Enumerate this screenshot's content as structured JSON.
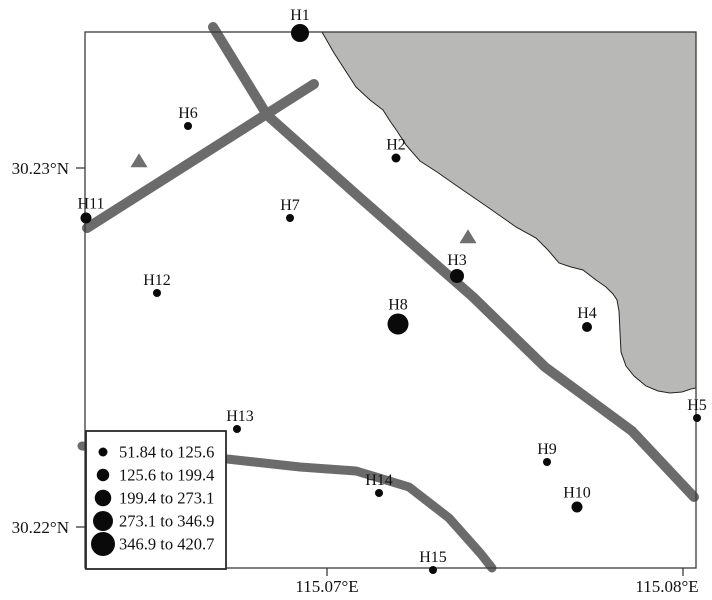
{
  "figure": {
    "kind": "station-map",
    "width": 712,
    "height": 600,
    "background": "#ffffff"
  },
  "colors": {
    "station": "#0a0a0a",
    "road": "#6b6b6b",
    "water_fill": "#b8b8b6",
    "water_outline": "#222222",
    "frame": "#3a3a3a",
    "triangle": "#6f6f6f",
    "legend_fill": "#ffffff",
    "legend_border": "#2a2a2a",
    "text": "#111111"
  },
  "map": {
    "frame": {
      "x": 85,
      "y": 32,
      "width": 611,
      "height": 536
    },
    "axes": {
      "tick_len": 9,
      "y_ticks": [
        {
          "label": "30.23°N",
          "y": 168
        },
        {
          "label": "30.22°N",
          "y": 527
        }
      ],
      "x_ticks": [
        {
          "label": "115.07°E",
          "x": 327,
          "label_x": 327
        },
        {
          "label": "115.08°E",
          "x": 683,
          "label_x": 667
        }
      ]
    },
    "water_area": {
      "name": "water-body",
      "points": [
        [
          322,
          32
        ],
        [
          334,
          53
        ],
        [
          345,
          70
        ],
        [
          356,
          87
        ],
        [
          370,
          100
        ],
        [
          383,
          110
        ],
        [
          390,
          121
        ],
        [
          397,
          131
        ],
        [
          406,
          145
        ],
        [
          420,
          161
        ],
        [
          437,
          172
        ],
        [
          457,
          186
        ],
        [
          489,
          208
        ],
        [
          516,
          227
        ],
        [
          536,
          238
        ],
        [
          548,
          250
        ],
        [
          559,
          263
        ],
        [
          571,
          267
        ],
        [
          583,
          270
        ],
        [
          596,
          280
        ],
        [
          606,
          287
        ],
        [
          613,
          294
        ],
        [
          617,
          300
        ],
        [
          619,
          311
        ],
        [
          620,
          332
        ],
        [
          621,
          352
        ],
        [
          626,
          366
        ],
        [
          634,
          376
        ],
        [
          646,
          386
        ],
        [
          658,
          391
        ],
        [
          670,
          393
        ],
        [
          682,
          392
        ],
        [
          691,
          389
        ],
        [
          696,
          388
        ],
        [
          696,
          32
        ]
      ]
    },
    "roads": [
      {
        "name": "road-northeast-diagonal",
        "width": 10,
        "points": [
          [
            213,
            27
          ],
          [
            267,
            115
          ],
          [
            358,
            196
          ],
          [
            473,
            297
          ],
          [
            545,
            367
          ],
          [
            632,
            431
          ],
          [
            694,
            497
          ]
        ]
      },
      {
        "name": "road-northwest-diagonal",
        "width": 10,
        "points": [
          [
            314,
            84
          ],
          [
            87,
            228
          ]
        ]
      },
      {
        "name": "road-south",
        "width": 9,
        "points": [
          [
            82,
            446
          ],
          [
            150,
            452
          ],
          [
            227,
            459
          ],
          [
            300,
            467
          ],
          [
            356,
            471
          ],
          [
            409,
            487
          ],
          [
            449,
            518
          ],
          [
            481,
            554
          ],
          [
            492,
            568
          ]
        ]
      }
    ],
    "triangles": [
      {
        "x": 139,
        "y": 161
      },
      {
        "x": 468,
        "y": 237
      }
    ],
    "triangle_size": {
      "w": 17,
      "h": 14
    },
    "stations": [
      {
        "id": "H1",
        "x": 300,
        "y": 33,
        "d": 18,
        "range": "273.1 to 346.9"
      },
      {
        "id": "H2",
        "x": 396,
        "y": 158,
        "d": 9,
        "range": "51.84 to 125.6"
      },
      {
        "id": "H3",
        "x": 457,
        "y": 276,
        "d": 14,
        "range": "199.4 to 273.1"
      },
      {
        "id": "H4",
        "x": 587,
        "y": 327,
        "d": 10,
        "range": "125.6 to 199.4"
      },
      {
        "id": "H5",
        "x": 697,
        "y": 418,
        "d": 8,
        "range": "51.84 to 125.6"
      },
      {
        "id": "H6",
        "x": 188,
        "y": 126,
        "d": 8,
        "range": "51.84 to 125.6"
      },
      {
        "id": "H7",
        "x": 290,
        "y": 218,
        "d": 8,
        "range": "51.84 to 125.6"
      },
      {
        "id": "H8",
        "x": 398,
        "y": 324,
        "d": 21,
        "range": "346.9 to 420.7"
      },
      {
        "id": "H9",
        "x": 547,
        "y": 462,
        "d": 8,
        "range": "51.84 to 125.6"
      },
      {
        "id": "H10",
        "x": 577,
        "y": 507,
        "d": 11,
        "range": "125.6 to 199.4"
      },
      {
        "id": "H11",
        "x": 86,
        "y": 218,
        "d": 11,
        "range": "125.6 to 199.4",
        "label_dx": 5
      },
      {
        "id": "H12",
        "x": 157,
        "y": 293,
        "d": 8,
        "range": "51.84 to 125.6"
      },
      {
        "id": "H13",
        "x": 237,
        "y": 429,
        "d": 8,
        "range": "51.84 to 125.6",
        "label_dx": 3
      },
      {
        "id": "H14",
        "x": 379,
        "y": 493,
        "d": 8,
        "range": "51.84 to 125.6"
      },
      {
        "id": "H15",
        "x": 433,
        "y": 570,
        "d": 8,
        "range": "51.84 to 125.6"
      }
    ],
    "legend": {
      "x": 86,
      "y": 431,
      "width": 140,
      "height": 138,
      "symbol_x": 103,
      "text_x": 119,
      "row_start_y": 452,
      "row_step": 23,
      "classes": [
        {
          "range": "51.84 to 125.6",
          "d": 9
        },
        {
          "range": "125.6 to 199.4",
          "d": 12.5
        },
        {
          "range": "199.4 to 273.1",
          "d": 16.5
        },
        {
          "range": "273.1 to 346.9",
          "d": 20
        },
        {
          "range": "346.9 to 420.7",
          "d": 24
        }
      ]
    }
  }
}
